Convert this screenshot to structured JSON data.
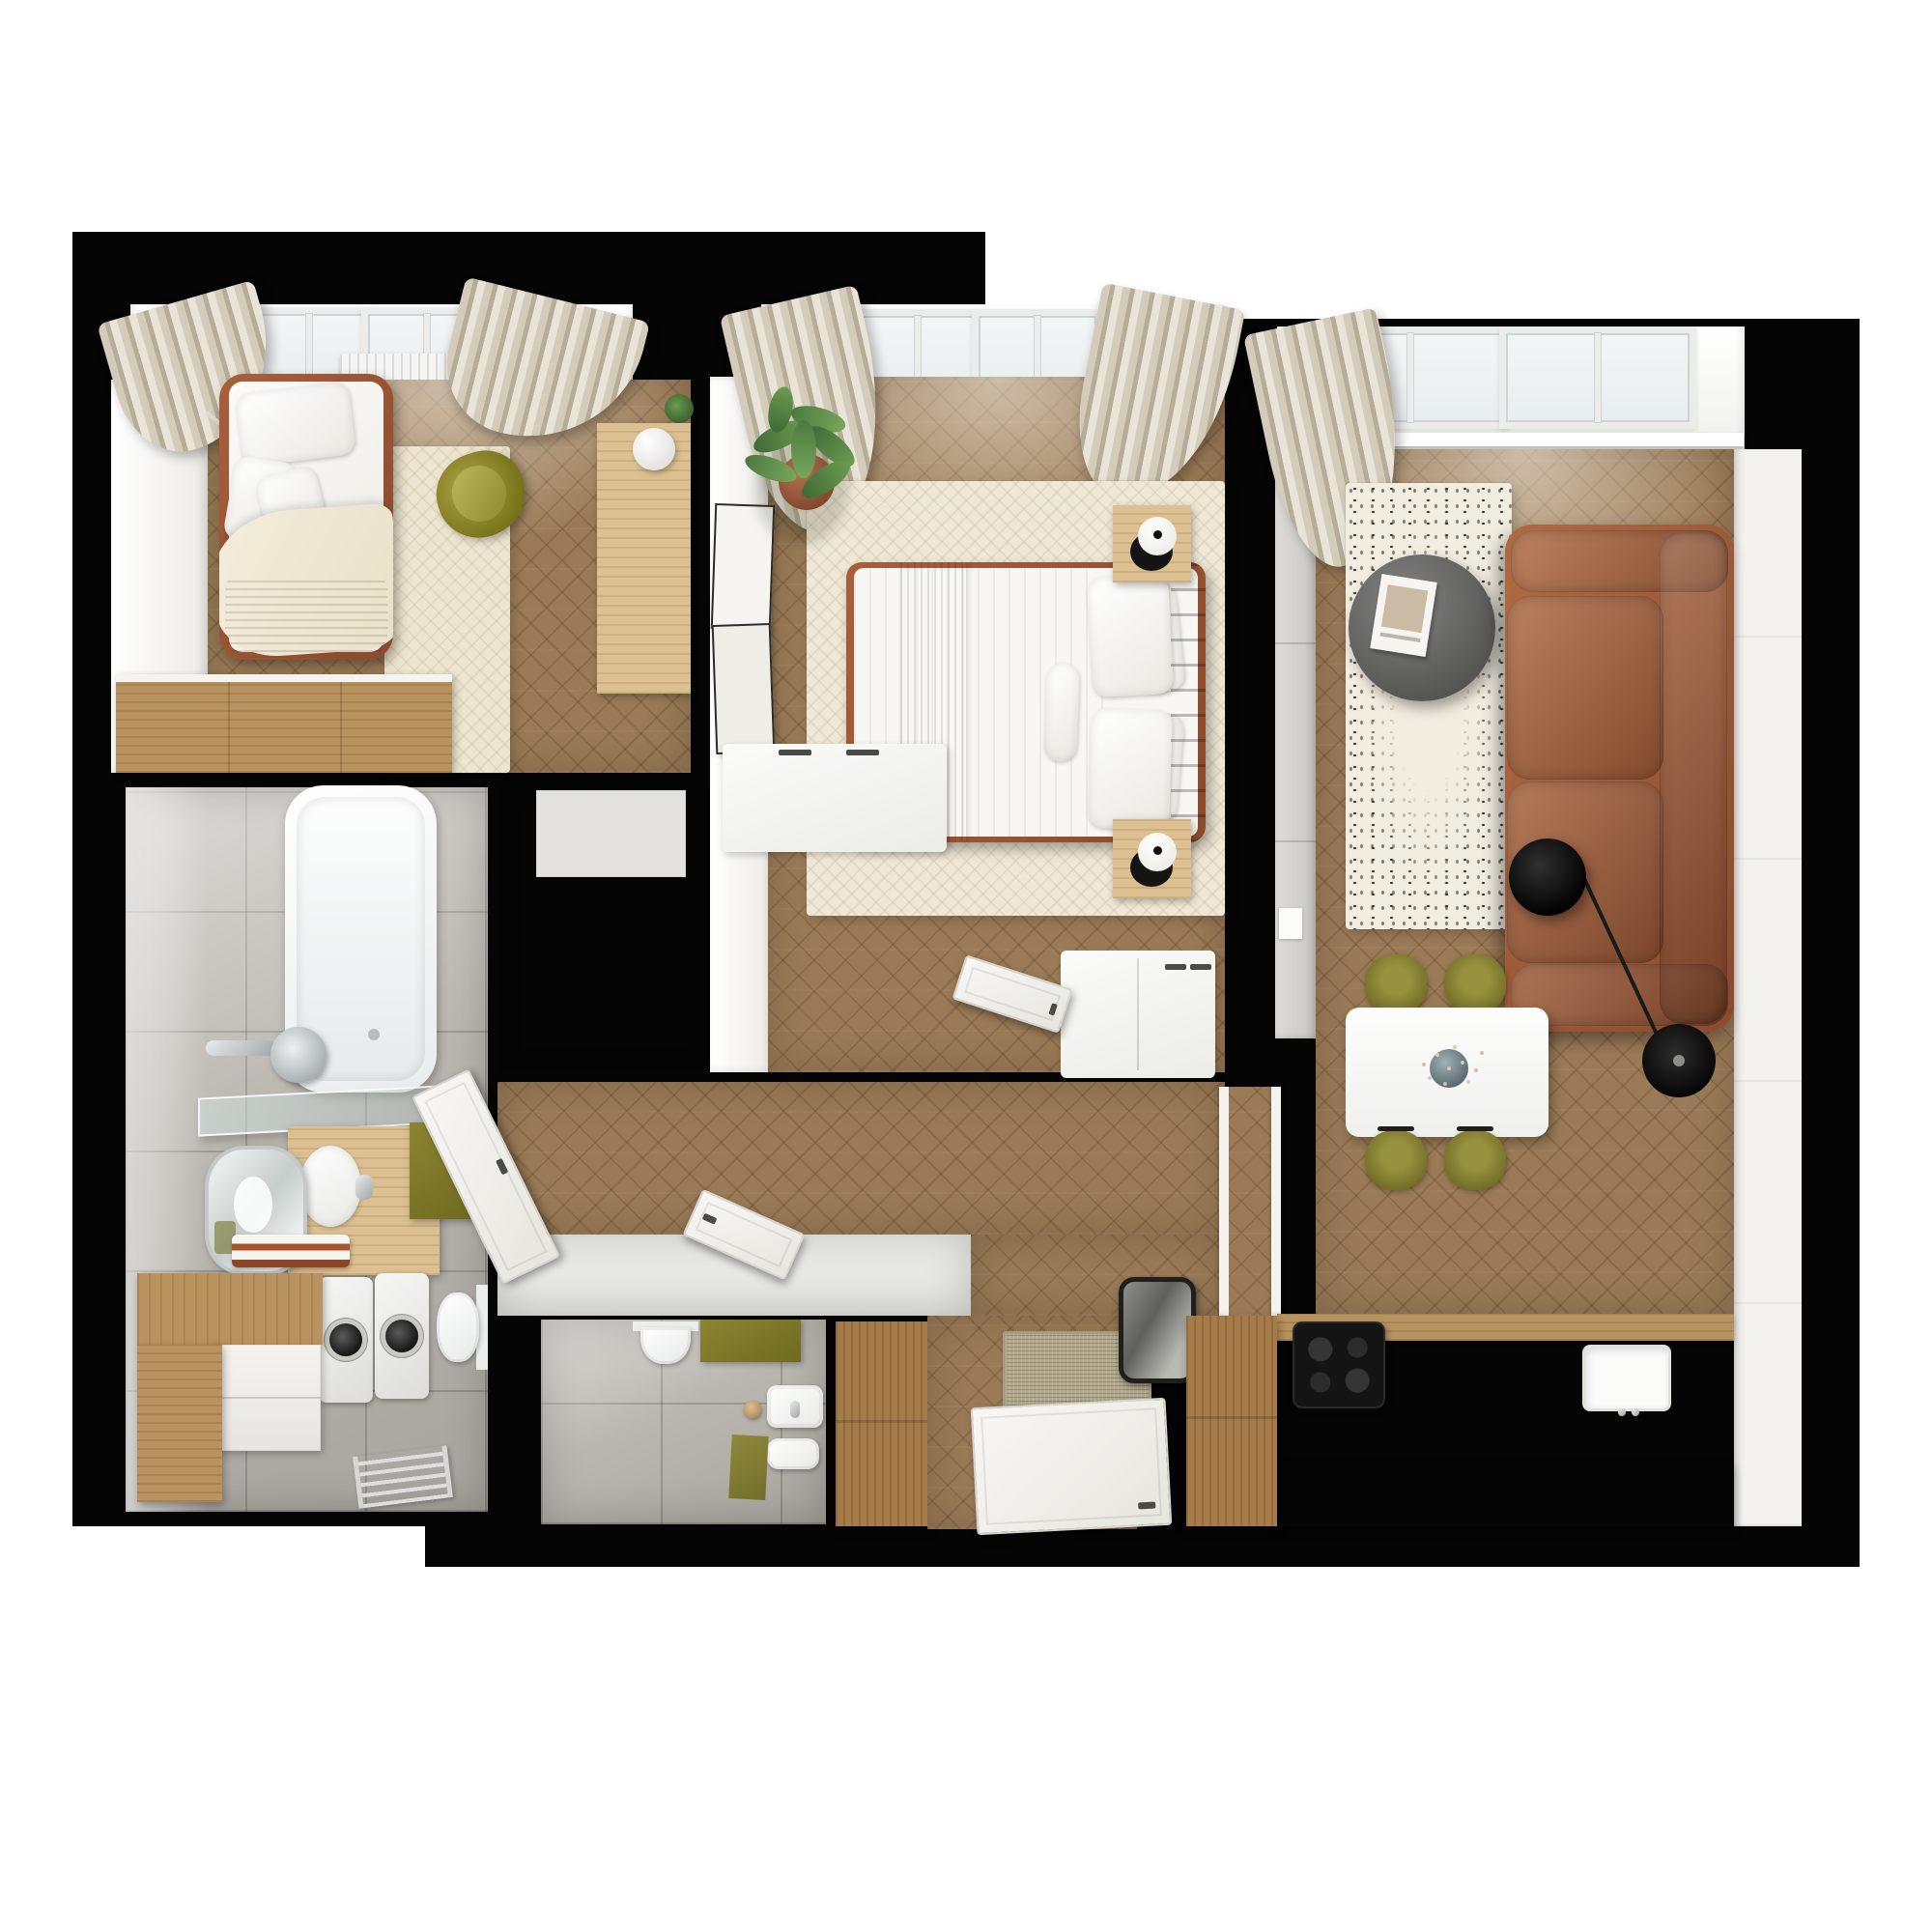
{
  "scene": {
    "type": "photorealistic 3D floor plan render, top-down view",
    "name": "Apartment floor plan",
    "description": "Top-down 3D visualization of an apartment with black wall silhouette on a white background",
    "view": "top-down"
  },
  "colors": {
    "page": "#ffffff",
    "wall": "#050505",
    "wood_floor": "#9b7b57",
    "wood_light": "#dcc091",
    "wood_medium": "#b9935f",
    "wood_dark": "#a57c49",
    "tile": "#bab6b0",
    "cream_rug": "#ede5d1",
    "olive": "#8c8531",
    "olive_dark": "#6e6a1f",
    "rust": "#a95e3c",
    "rust_dark": "#8a4a2c",
    "sofa_rust": "#b06a42",
    "curtain": "#d4ccba",
    "curtain_dark": "#b6ad99",
    "appliance_black": "#141414",
    "table_gray": "#6e6e6c",
    "plant_green": "#4b7a41",
    "doormat": "#b2a88c",
    "mirror_frame": "#1f1f1d"
  },
  "rooms": {
    "kids_bedroom": {
      "name": "Children's bedroom",
      "furniture": [
        "single bed with rust frame and olive blanket",
        "wall lamp",
        "cream rug",
        "olive armchair",
        "wooden desk with ball lamp",
        "wooden dresser",
        "two windows with beige curtains",
        "radiator"
      ]
    },
    "master_bedroom": {
      "name": "Master bedroom",
      "furniture": [
        "double bed with rust headboard and olive runner",
        "two wooden nightstands with black lamps",
        "cream rug",
        "potted plant",
        "leaning picture frames",
        "white bench",
        "white dresser",
        "two windows with curtains",
        "radiator"
      ]
    },
    "bathroom": {
      "name": "Bathroom",
      "furniture": [
        "bathtub with shower",
        "glass shelf",
        "wooden vanity with oval sink",
        "mirror",
        "towels",
        "olive cabinet",
        "wall-hung toilet",
        "washing machine",
        "dryer",
        "white cabinet with wooden top",
        "towel radiator"
      ]
    },
    "hallway": {
      "name": "Hallway",
      "furniture": [
        "white built-in wardrobes",
        "open white doors",
        "chevron parquet floor"
      ]
    },
    "wc": {
      "name": "Guest WC",
      "furniture": [
        "wall-hung toilet",
        "washbasin",
        "bidet",
        "olive mat",
        "wooden stool"
      ]
    },
    "entry": {
      "name": "Entryway",
      "furniture": [
        "tall wooden wardrobe",
        "woven doormat",
        "open entry door",
        "black framed mirror"
      ]
    },
    "living_kitchen": {
      "name": "Living room with kitchen",
      "furniture": [
        "rust two-seat sofa",
        "speckled rug",
        "round gray coffee table with magazine",
        "black arc floor lamp",
        "white dining table with vase",
        "four olive dining chairs",
        "kitchen counter with induction hob and sink",
        "wooden cabinet block",
        "tall gray unit",
        "two windows with curtain"
      ]
    }
  }
}
